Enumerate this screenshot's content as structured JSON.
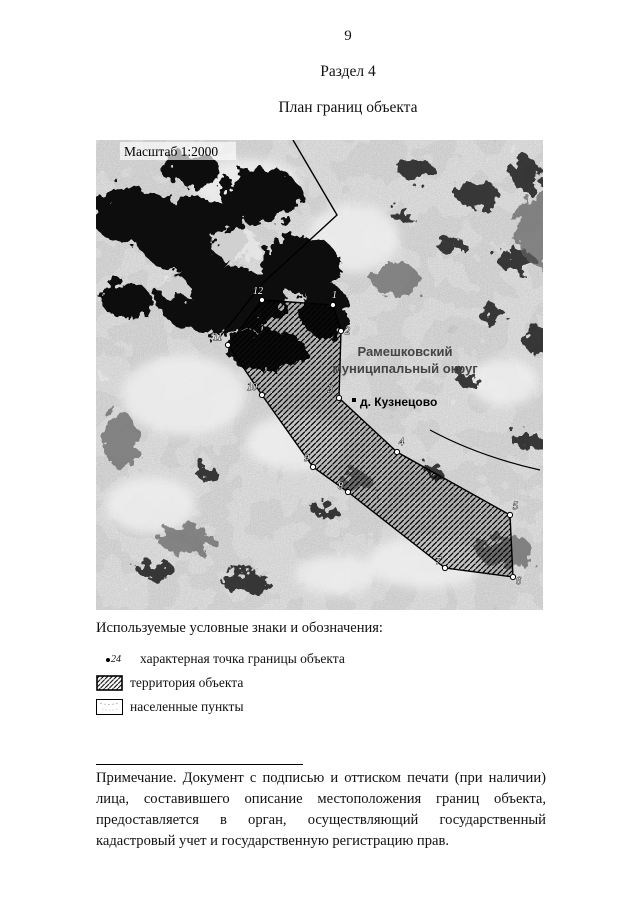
{
  "page": {
    "number": "9",
    "section": "Раздел 4",
    "title": "План границ объекта"
  },
  "map": {
    "scale_label": "Масштаб 1:2000",
    "region_label": [
      "Рамешковский",
      "муниципальный округ"
    ],
    "settlement_label": "д. Кузнецово",
    "boundary_points": [
      {
        "n": "12",
        "x": 166,
        "y": 160,
        "lx": 157,
        "ly": 154
      },
      {
        "n": "1",
        "x": 237,
        "y": 165,
        "lx": 236,
        "ly": 158
      },
      {
        "n": "2",
        "x": 245,
        "y": 191,
        "lx": 249,
        "ly": 194
      },
      {
        "n": "3",
        "x": 243,
        "y": 258,
        "lx": 232,
        "ly": 252
      },
      {
        "n": "4",
        "x": 301,
        "y": 312,
        "lx": 303,
        "ly": 305
      },
      {
        "n": "5",
        "x": 414,
        "y": 375,
        "lx": 417,
        "ly": 369
      },
      {
        "n": "6",
        "x": 417,
        "y": 437,
        "lx": 420,
        "ly": 444
      },
      {
        "n": "7",
        "x": 349,
        "y": 428,
        "lx": 340,
        "ly": 424
      },
      {
        "n": "8",
        "x": 252,
        "y": 352,
        "lx": 242,
        "ly": 349
      },
      {
        "n": "9",
        "x": 217,
        "y": 327,
        "lx": 208,
        "ly": 321
      },
      {
        "n": "10",
        "x": 166,
        "y": 255,
        "lx": 151,
        "ly": 250
      },
      {
        "n": "11",
        "x": 132,
        "y": 205,
        "lx": 117,
        "ly": 200
      }
    ]
  },
  "legend": {
    "title": "Используемые условные знаки и обозначения:",
    "point_item": {
      "number": "24",
      "label": "характерная точка границы объекта"
    },
    "territory_item": {
      "label": "территория объекта"
    },
    "settlement_item": {
      "label": "населенные пункты"
    }
  },
  "note": {
    "text": "Примечание. Документ с подписью и оттиском печати (при наличии) лица, составившего описание местоположения границ объекта, предоставляется в орган, осуществляющий государственный кадастровый учет и государственную регистрацию прав."
  },
  "colors": {
    "map_base": "#a2a2a2",
    "forest": "#0c0c0c",
    "region_label": "#444444",
    "hatch": "#000000"
  }
}
